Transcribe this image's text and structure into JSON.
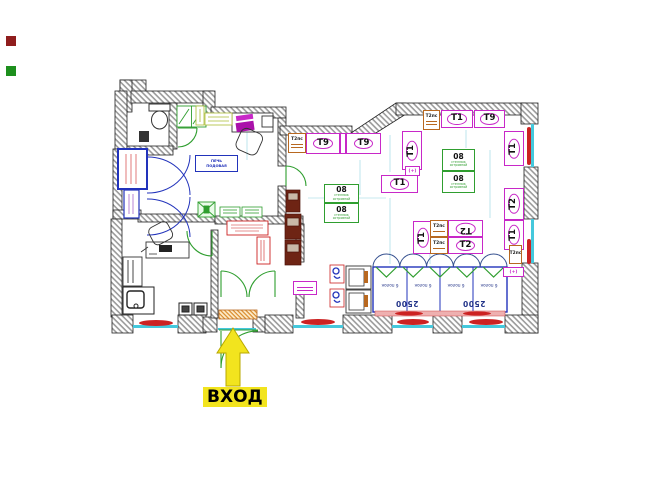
{
  "legend": {
    "entrance_label": "ВХОД"
  },
  "tags": {
    "t9": "Т9",
    "t1": "Т1",
    "t2": "Т2",
    "t2ps": "Т2пс",
    "plus": "(+)",
    "code08": "08",
    "island_line1": "стеллаж",
    "island_line2": "островной"
  },
  "display_case": {
    "shelf_label": "6 полок",
    "width_label": "2500"
  },
  "equipment": {
    "oven_line1": "ПЕЧЬ",
    "oven_line2": "ПОДОВАЯ"
  },
  "colors": {
    "magenta": "#c828c8",
    "green": "#2f9e2f",
    "blue": "#2233bb",
    "orange": "#b86820",
    "red": "#cc2222",
    "cyan": "#45c8dc",
    "yellow": "#f2e41e",
    "wall_stripe": "#9a9a9a",
    "legend_red": "#8f1d1d",
    "legend_green": "#1d8f1d"
  }
}
